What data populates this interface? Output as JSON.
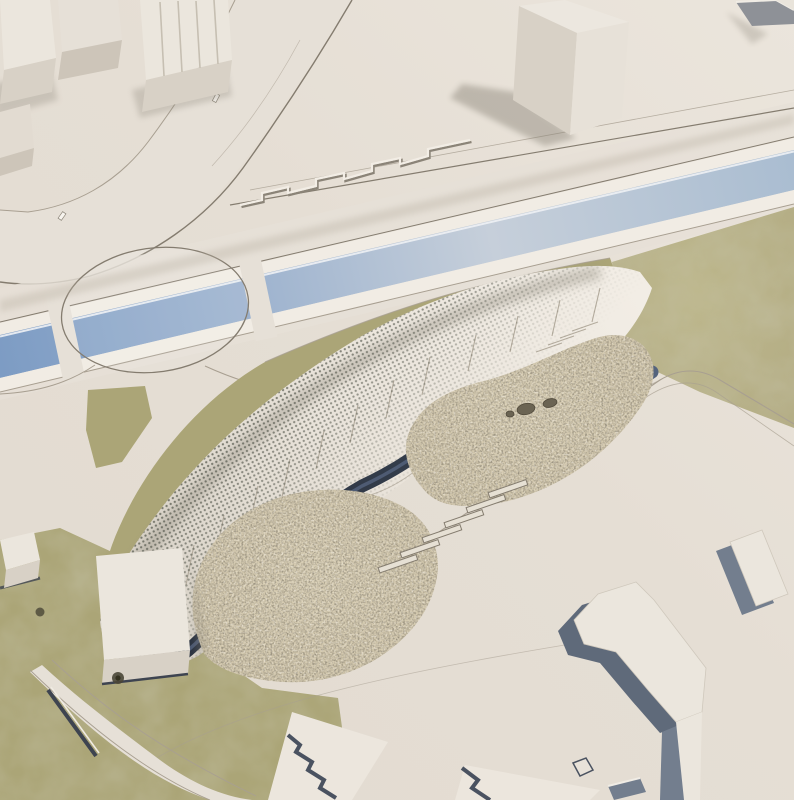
{
  "meta": {
    "kind": "architectural-aerial-render",
    "description": "Bird's-eye 3D rendering of an urban site: a blue canal crosses diagonally through an elliptical roundabout; a long curved landscape building with a perforated canopy roof, a dark sunken trench and two dry-grass mounds occupies the center; white massing-model towers sit above the canal and white slab buildings with shaded faces sit at the lower right."
  },
  "colors": {
    "ground": "#e2dbd1",
    "ground_light": "#ebe5dc",
    "road_fill": "#e6e0d7",
    "road_line": "#a89f91",
    "road_line_dark": "#847c6f",
    "curb_light": "#f1ece4",
    "water_deep": "#7d9cc4",
    "water_mid": "#9fb4cf",
    "water_pale": "#c6cfda",
    "water_soft": "#aabdd1",
    "grass": "#aba577",
    "grass_light": "#bdb78c",
    "field": "#b3ac84",
    "field_dark": "#8f8a63",
    "veg_base": "#cfc4a9",
    "veg_dark": "#453e2f",
    "veg_light": "#efe7d2",
    "canopy_dot": "#4b4f44",
    "roof_light": "#f2ede5",
    "roof_shade": "#d8d2c7",
    "slit_line": "#b3ab9d",
    "trench_dark": "#333c4a",
    "trench_mid": "#55647e",
    "white_building": "#ebe6dd",
    "building_face": "#d8d1c6",
    "building_face_dark": "#cdc5b9",
    "slab_side": "#737e8e",
    "slab_side_dark": "#5f6a7a",
    "shadow": "#8a8478",
    "stone": "#6b6453",
    "stone_edge": "#514a3b",
    "tree_dark": "#4a4636",
    "car_white": "#f7f4ee"
  },
  "objects": [
    {
      "name": "canal-water",
      "kind": "water channel"
    },
    {
      "name": "roundabout",
      "kind": "elliptical traffic circle"
    },
    {
      "name": "boulevard-road",
      "kind": "curved road"
    },
    {
      "name": "main-building-roof",
      "kind": "curved canopy building"
    },
    {
      "name": "canopy-dot-texture",
      "kind": "perforated roof"
    },
    {
      "name": "roof-trench",
      "kind": "sunken dark walkway"
    },
    {
      "name": "vegetation-mound-west",
      "kind": "dry grass planting"
    },
    {
      "name": "vegetation-mound-east",
      "kind": "dry grass planting"
    },
    {
      "name": "meadow-field",
      "kind": "green field"
    },
    {
      "name": "lawn-southwest",
      "kind": "lawn"
    },
    {
      "name": "tower-top-center",
      "kind": "white massing tower"
    },
    {
      "name": "towers-top-left",
      "kind": "white massing blocks"
    },
    {
      "name": "slab-complex-southeast",
      "kind": "white slabs with shaded faces"
    },
    {
      "name": "white-box-pavilion",
      "kind": "small white building"
    },
    {
      "name": "stepped-benches",
      "kind": "terraced steps"
    },
    {
      "name": "boulders",
      "kind": "stones"
    }
  ]
}
